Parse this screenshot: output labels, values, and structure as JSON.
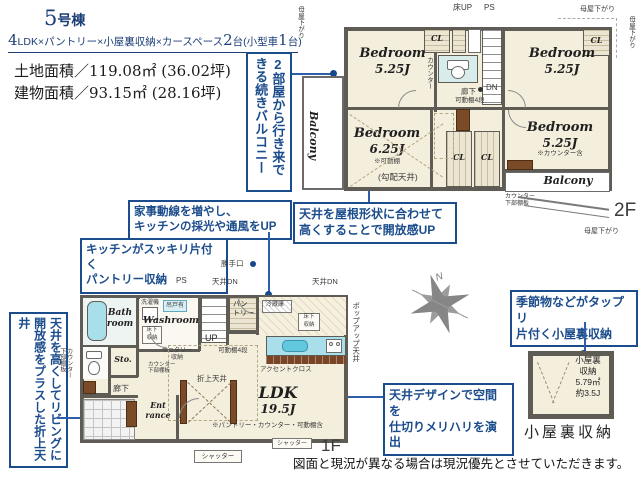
{
  "header": {
    "building_no": "5",
    "building_suffix": "号棟",
    "spec": {
      "n1": "4",
      "t1": "LDK×パントリー×小屋裏収納×カースペース",
      "n2": "2",
      "t2": "台(小型車",
      "n3": "1",
      "t3": "台)"
    },
    "land_area": "土地面積／119.08㎡ (36.02坪)",
    "building_area": "建物面積／93.15㎡ (28.16坪)"
  },
  "callouts": {
    "balcony": "2部屋から行き来できる続きバルコニー",
    "housework": "家事動線を増やし、\nキッチンの採光や通風をUP",
    "pantry": "キッチンがスッキリ片付く\nパントリー収納",
    "sloped_ceiling": "天井を屋根形状に合わせて\n高くすることで開放感UP",
    "living_ceiling": "天井を高くしてリビングに開放感をプラスした折上天井",
    "attic": "季節物などがタップリ\n片付く小屋裏収納",
    "divider": "天井デザインで空間を\n仕切りメリハリを演出"
  },
  "plan2f": {
    "floor": "2F",
    "balcony": "Balcony",
    "bed1_name": "Bedroom",
    "bed1_size": "5.25J",
    "bed2_name": "Bedroom",
    "bed2_size": "5.25J",
    "bed3_name": "Bedroom",
    "bed3_size": "6.25J",
    "bed3_note": "※可動棚",
    "bed3_note2": "(勾配天井)",
    "bed4_name": "Bedroom",
    "bed4_size": "5.25J",
    "bed4_note": "※カウンター含",
    "cl": "CL",
    "floor_up": "床UP",
    "ps": "PS",
    "dn": "DN",
    "hallway": "廊下",
    "shelf": "可動棚4段",
    "counter": "カウンター",
    "counter_shelf": "カウンター\n下部棚板",
    "moya": "母屋下がり"
  },
  "plan1f": {
    "floor": "1F",
    "ldk_name": "LDK",
    "ldk_size": "19.5J",
    "ldk_note": "※パントリー・カウンター・可動棚含",
    "bath": "Bath\nroom",
    "washroom": "Washroom",
    "washer": "洗濯機",
    "hanging_cab": "吊戸有",
    "underfloor": "床下\n収納",
    "underfloor_kitchen": "床下\n収納",
    "sanitary": "サニタリー\n収納",
    "counter_shelf": "カウンター\n下部棚板",
    "counter_shelf_left": "カウンター\n下部棚板",
    "sto": "Sto.",
    "hallway": "廊下",
    "entrance": "Ent\nrance",
    "pantry": "パン\nトリー",
    "pantry_shelf": "可動棚4段",
    "up": "UP",
    "ps": "PS",
    "ceiling_dn": "天井DN",
    "back_door": "勝手口",
    "fridge": "冷蔵庫",
    "popup_ceiling": "ポップアップ天井",
    "accent": "アクセントクロス",
    "raised_ceiling": "折上天井",
    "shutter": "シャッター"
  },
  "attic": {
    "room_text": "小屋裏\n収納\n5.79㎡\n約3.5J",
    "caption": "小屋裏収納"
  },
  "compass": {
    "n": "N"
  },
  "disclaimer": "図面と現況が異なる場合は現況優先とさせていただきます。"
}
